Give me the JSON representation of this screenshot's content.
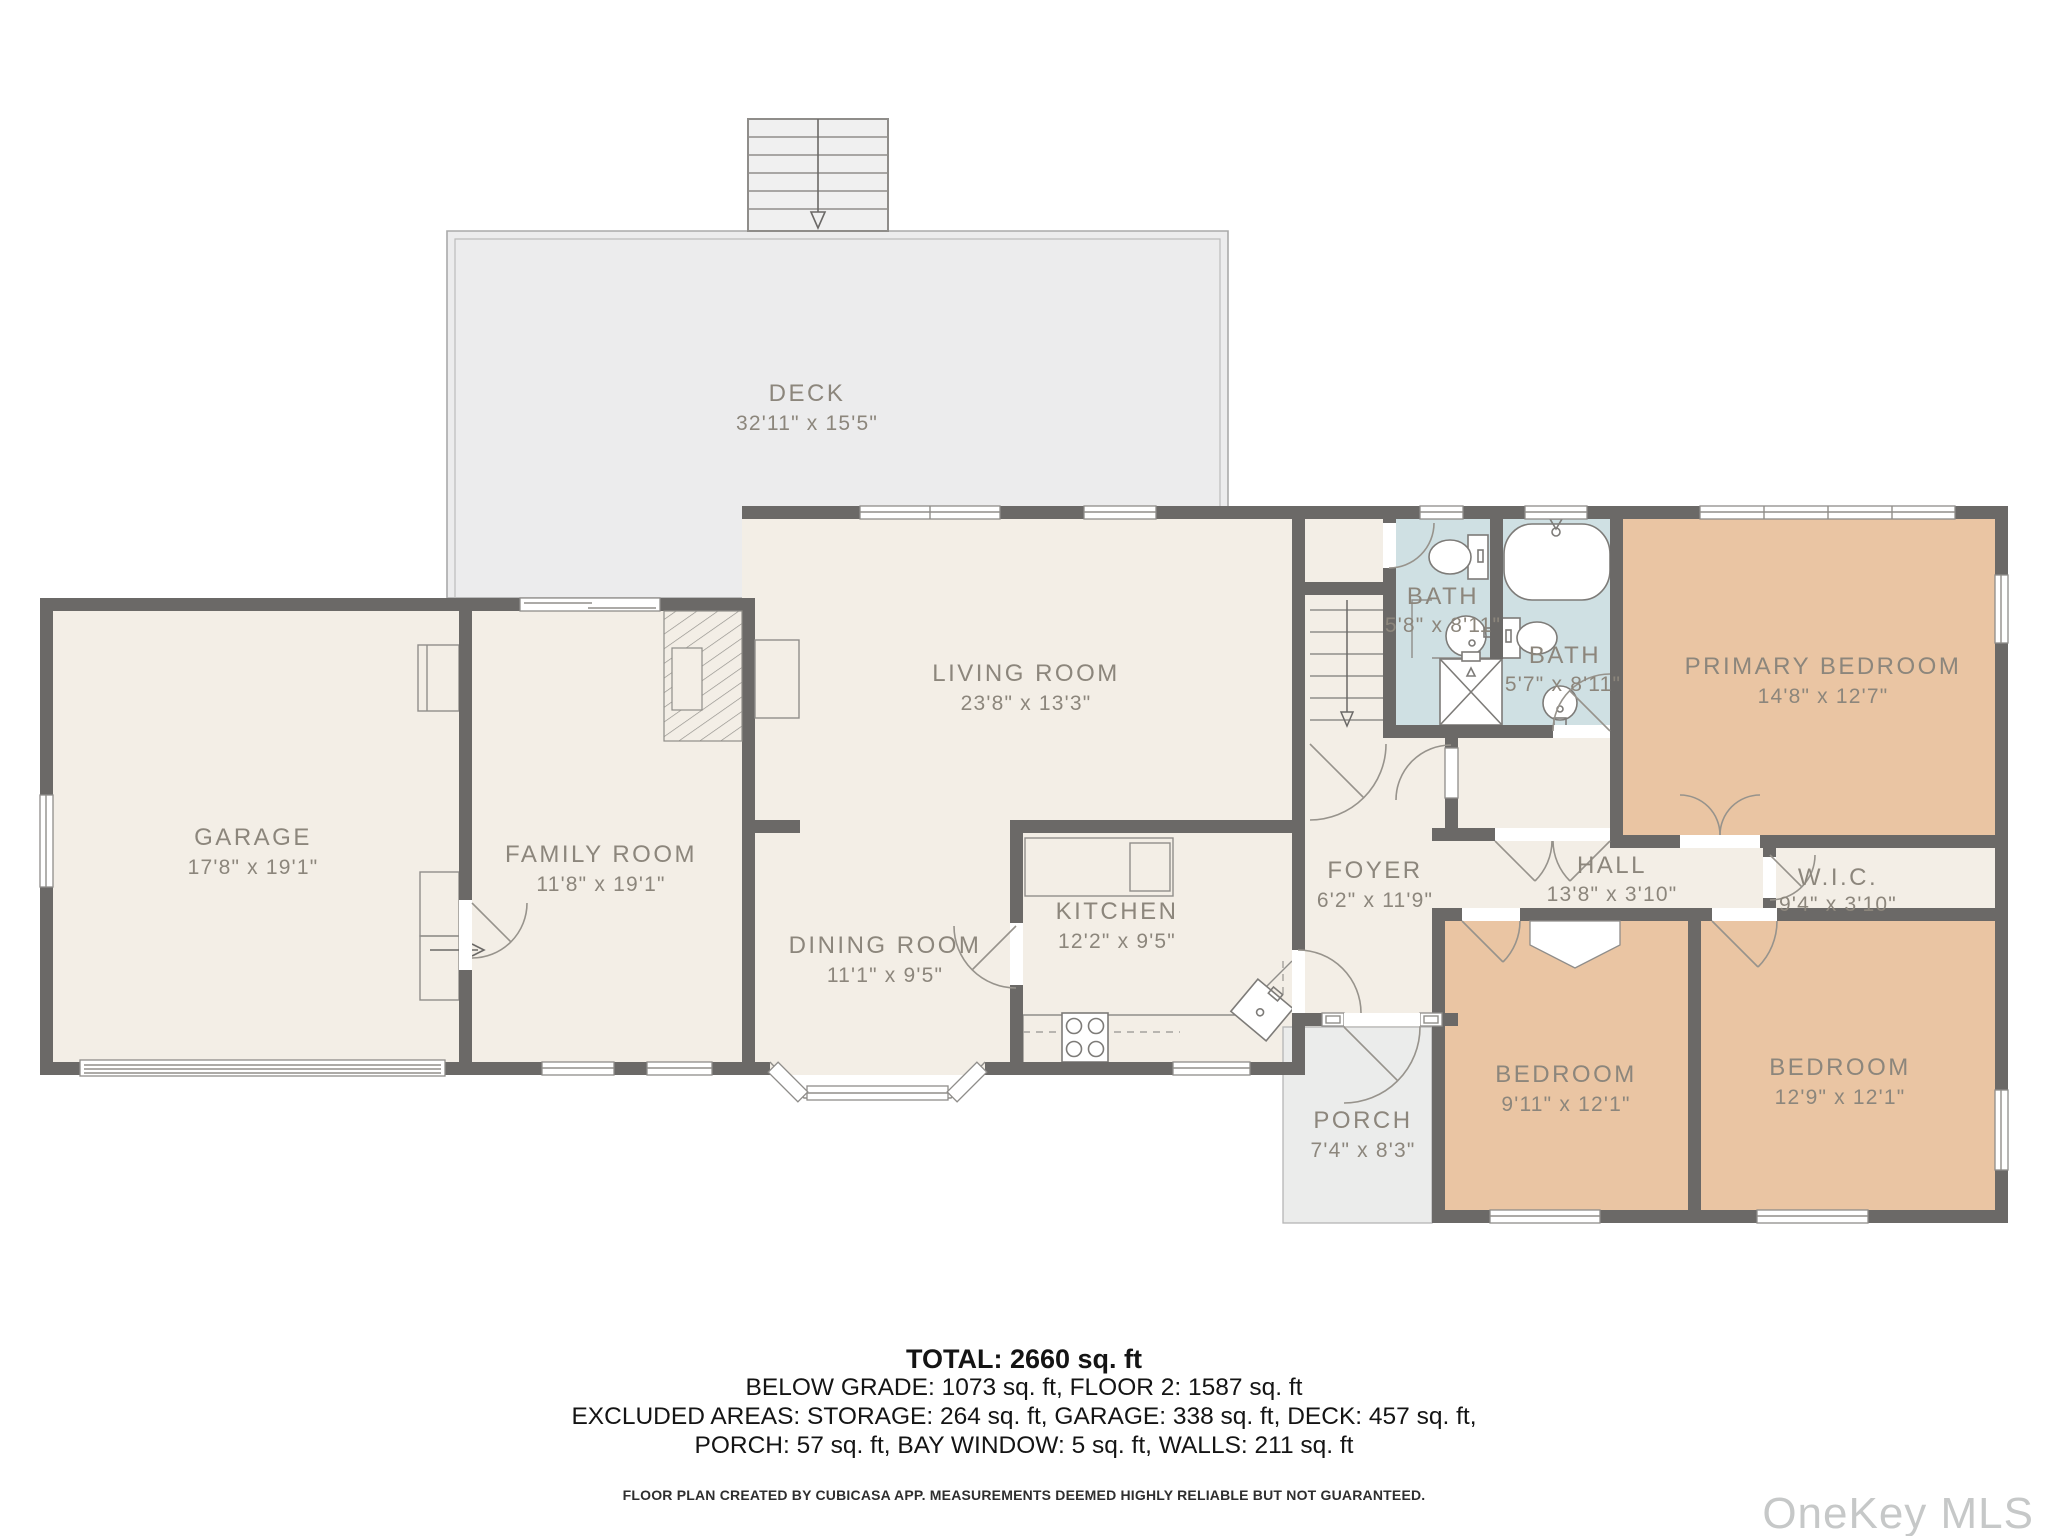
{
  "plan": {
    "colors": {
      "wall": "#6b6967",
      "interior": "#f3eee6",
      "bath": "#cfe0e3",
      "bedroom": "#eac5a3",
      "outdoor": "#ececed",
      "label": "#8c867c"
    },
    "rooms": [
      {
        "key": "deck",
        "name": "DECK",
        "dims": "32'11\" x 15'5\""
      },
      {
        "key": "garage",
        "name": "GARAGE",
        "dims": "17'8\" x 19'1\""
      },
      {
        "key": "family-room",
        "name": "FAMILY ROOM",
        "dims": "11'8\" x 19'1\""
      },
      {
        "key": "living-room",
        "name": "LIVING ROOM",
        "dims": "23'8\" x 13'3\""
      },
      {
        "key": "dining-room",
        "name": "DINING ROOM",
        "dims": "11'1\" x 9'5\""
      },
      {
        "key": "kitchen",
        "name": "KITCHEN",
        "dims": "12'2\" x 9'5\""
      },
      {
        "key": "foyer",
        "name": "FOYER",
        "dims": "6'2\" x 11'9\""
      },
      {
        "key": "bath-1",
        "name": "BATH",
        "dims": "5'8\" x 8'11\""
      },
      {
        "key": "bath-2",
        "name": "BATH",
        "dims": "5'7\" x 8'11\""
      },
      {
        "key": "primary-bedroom",
        "name": "PRIMARY BEDROOM",
        "dims": "14'8\" x 12'7\""
      },
      {
        "key": "hall",
        "name": "HALL",
        "dims": "13'8\" x 3'10\""
      },
      {
        "key": "wic",
        "name": "W.I.C.",
        "dims": "9'4\" x 3'10\""
      },
      {
        "key": "bedroom-1",
        "name": "BEDROOM",
        "dims": "9'11\" x 12'1\""
      },
      {
        "key": "bedroom-2",
        "name": "BEDROOM",
        "dims": "12'9\" x 12'1\""
      },
      {
        "key": "porch",
        "name": "PORCH",
        "dims": "7'4\" x 8'3\""
      }
    ]
  },
  "summary": {
    "total": "TOTAL: 2660 sq. ft",
    "line2": "BELOW GRADE: 1073 sq. ft, FLOOR 2: 1587 sq. ft",
    "line3": "EXCLUDED AREAS: STORAGE: 264 sq. ft, GARAGE: 338 sq. ft, DECK: 457 sq. ft,",
    "line4": "PORCH: 57 sq. ft, BAY WINDOW: 5 sq. ft, WALLS: 211 sq. ft",
    "disclaimer": "FLOOR PLAN CREATED BY CUBICASA APP. MEASUREMENTS DEEMED HIGHLY RELIABLE BUT NOT GUARANTEED."
  },
  "watermark": "OneKey MLS"
}
